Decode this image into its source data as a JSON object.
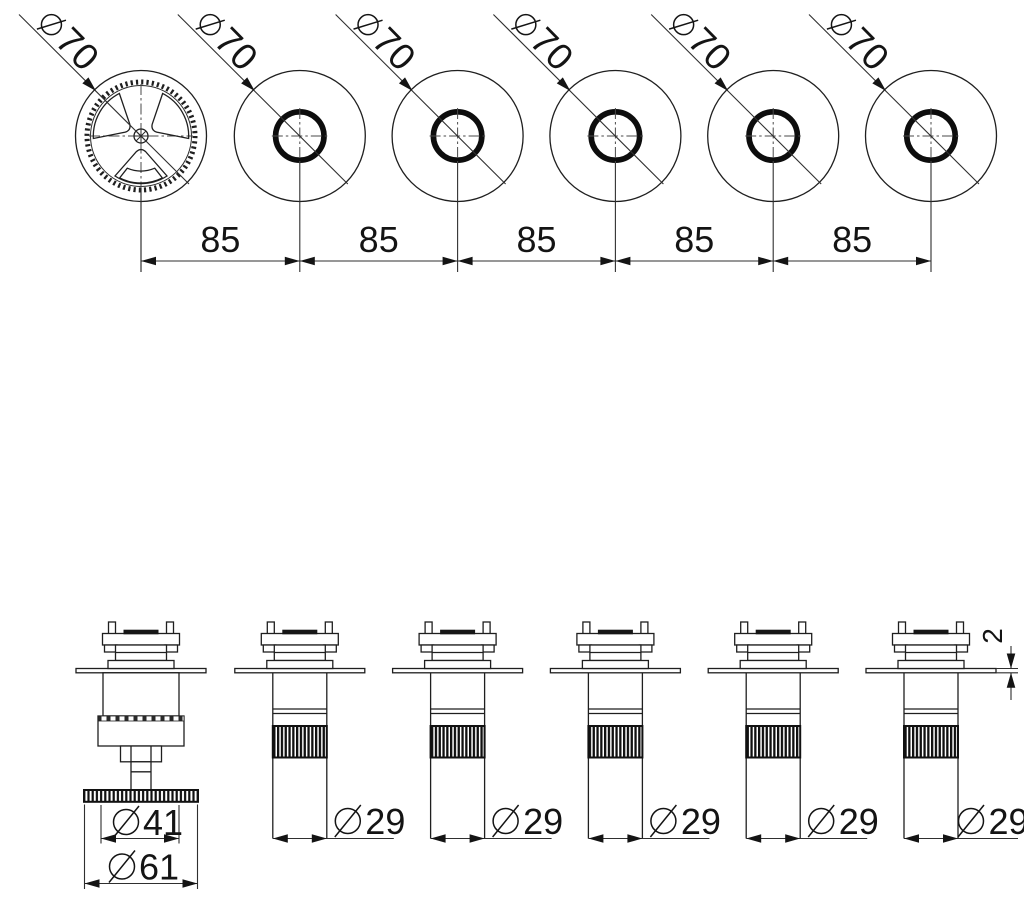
{
  "drawing": {
    "description": "Technical dimension drawing of a six-valve wall mixer trim: top views and side elevations",
    "colors": {
      "line_color": "#1f1f1f",
      "centerline_color": "#4a4a4a",
      "background": "#ffffff"
    },
    "top_view": {
      "diameter_symbol": "diameter-sign",
      "diameters": [
        "70",
        "70",
        "70",
        "70",
        "70",
        "70"
      ],
      "spacings": [
        "85",
        "85",
        "85",
        "85",
        "85"
      ]
    },
    "side_view": {
      "handle_knob_diameter": "41",
      "handle_base_diameter": "61",
      "valve_body_diameters": [
        "29",
        "29",
        "29",
        "29",
        "29"
      ],
      "plate_thickness": "2"
    }
  }
}
